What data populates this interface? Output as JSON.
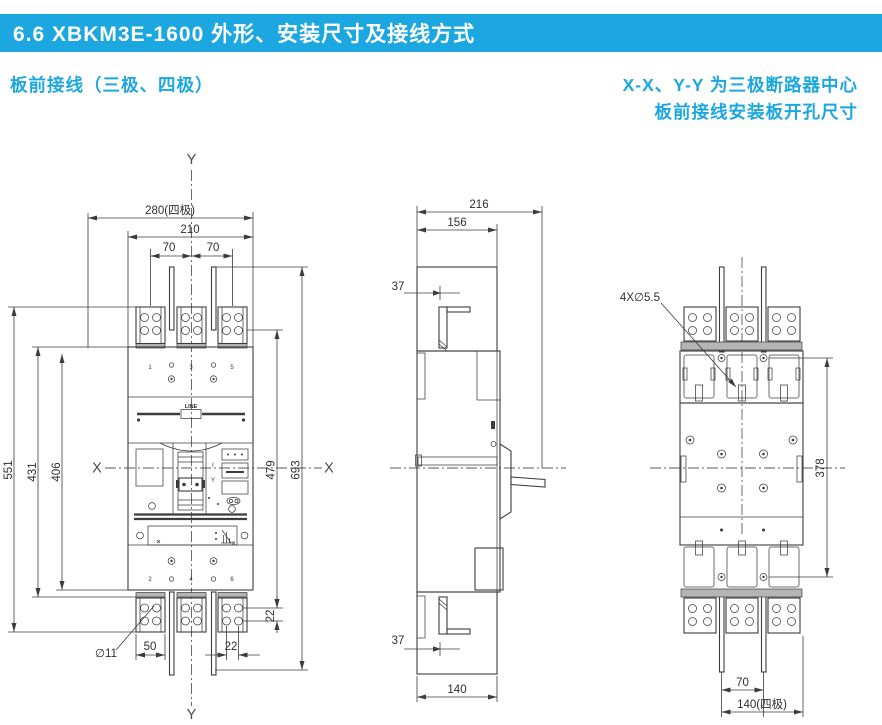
{
  "header": {
    "title": "6.6 XBKM3E-1600 外形、安装尺寸及接线方式"
  },
  "subtitles": {
    "left": "板前接线（三极、四极）",
    "right_line1": "X-X、Y-Y 为三极断路器中心",
    "right_line2": "板前接线安装板开孔尺寸"
  },
  "front_view": {
    "axis": {
      "y_top": "Y",
      "y_bottom": "Y",
      "x_left": "X",
      "x_right": "X"
    },
    "dims": {
      "overall_width_4p": "280(四极)",
      "body_width": "210",
      "pole_pitch_1": "70",
      "pole_pitch_2": "70",
      "overall_height": "551",
      "upper_height": "431",
      "body_height": "406",
      "terminal_span": "479",
      "busbar_span": "693",
      "hole_row_pitch": "22",
      "hole_col_pitch": "22",
      "pad_width": "50",
      "hole_dia": "∅11"
    },
    "face": {
      "line_label": "LINE",
      "top_terminals": [
        "1",
        "3",
        "5"
      ],
      "bottom_terminals": [
        "2",
        "4",
        "6"
      ],
      "mark_i": "I",
      "mark_y": "Y"
    }
  },
  "side_view": {
    "dims": {
      "depth_overall": "216",
      "depth_inner": "156",
      "lug_offset_top": "37",
      "lug_offset_bottom": "37",
      "base_depth": "140"
    }
  },
  "drill_plan": {
    "dims": {
      "mounting_holes": "4X∅5.5",
      "vertical_span": "378",
      "pole_pitch": "70",
      "width_4p": "140(四极)"
    }
  },
  "colors": {
    "accent": "#1ca7e0",
    "line": "#3c3c3c"
  }
}
